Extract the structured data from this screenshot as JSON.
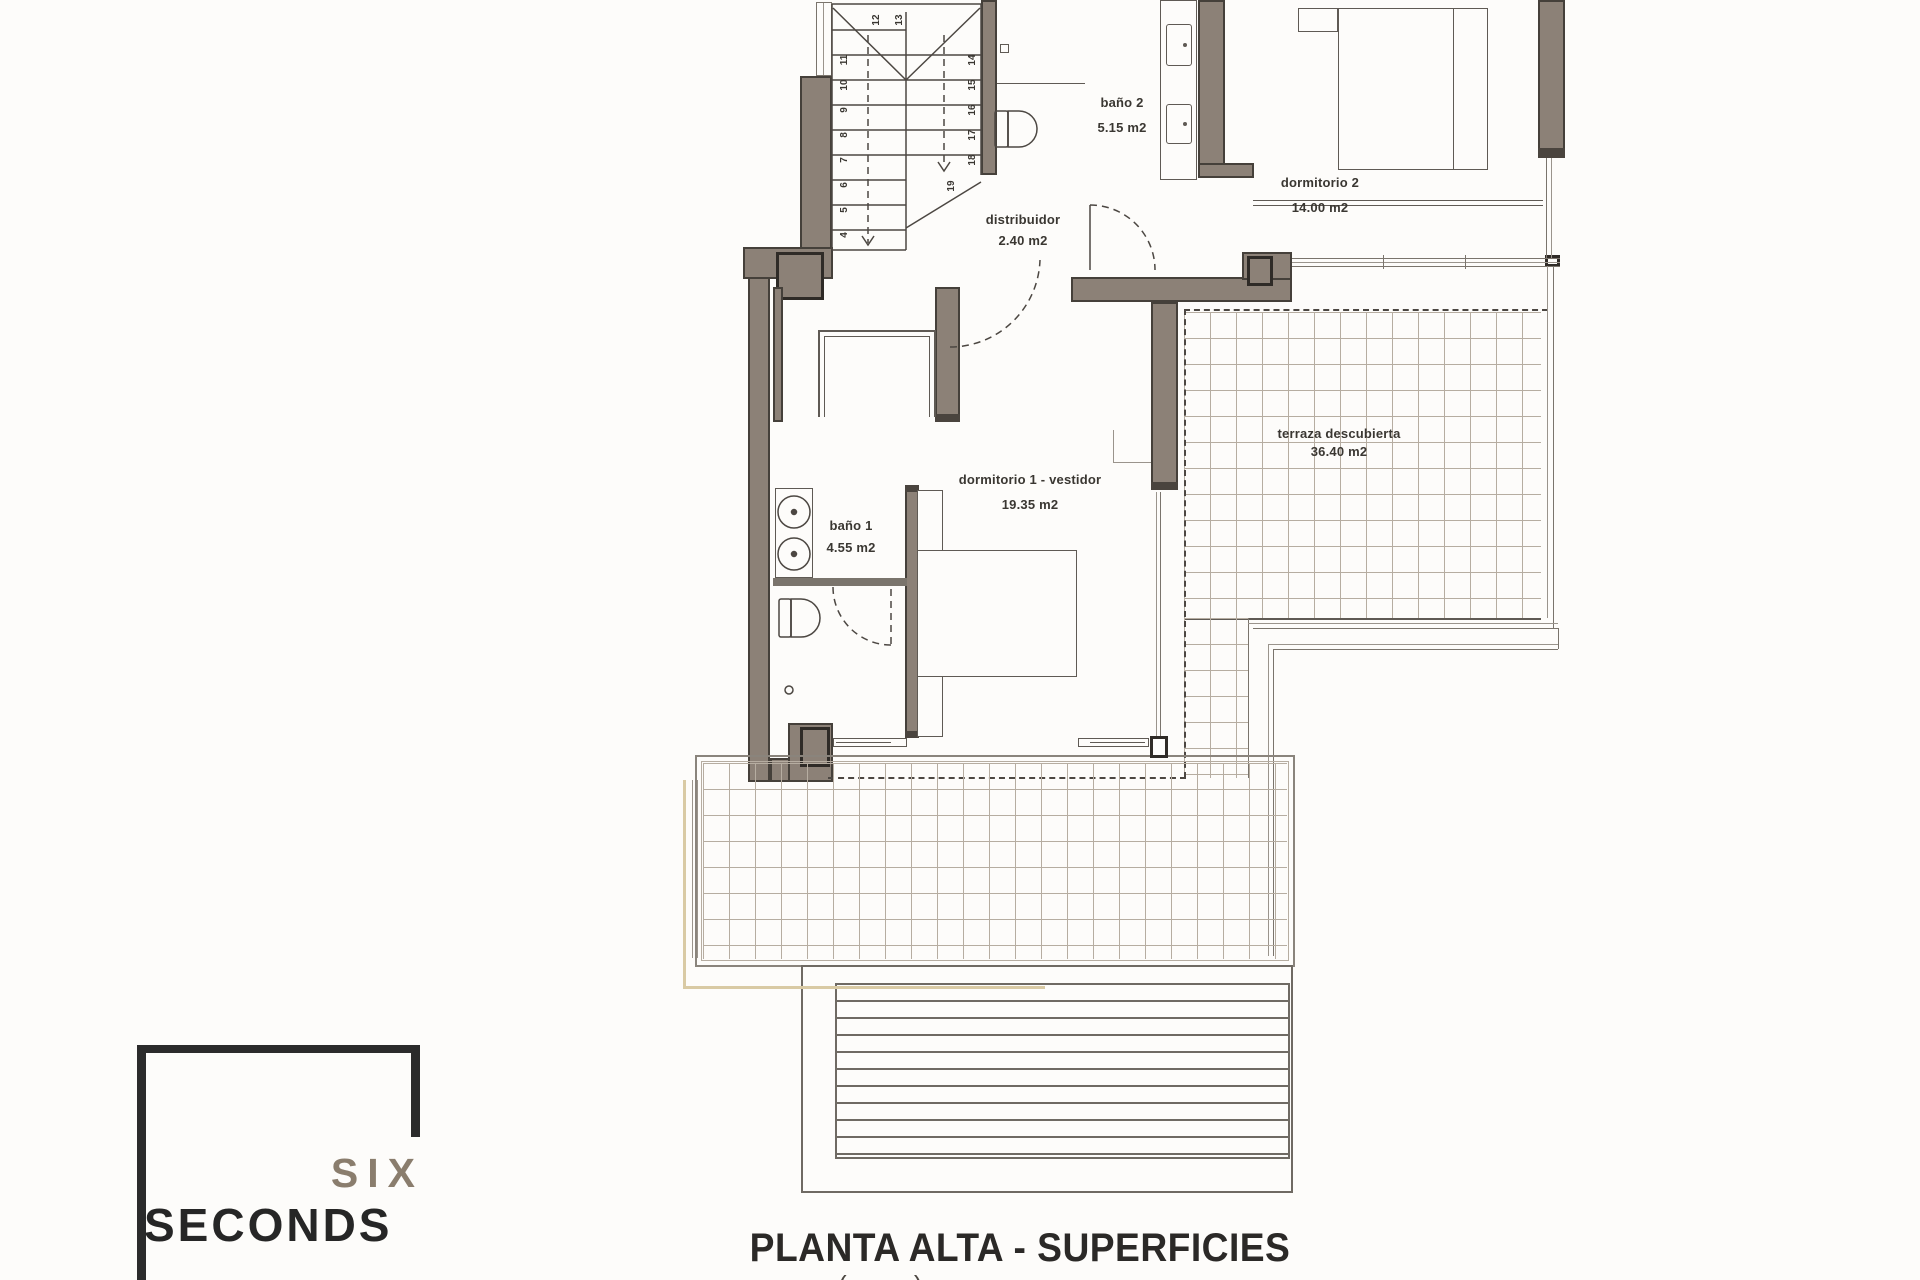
{
  "title": "PLANTA ALTA - SUPERFICIES",
  "footer_partial": "( )",
  "logo": {
    "line1": "SIX",
    "line2": "SECONDS"
  },
  "rooms": [
    {
      "id": "bano2",
      "name": "baño 2",
      "area": "5.15 m2"
    },
    {
      "id": "dormitorio2",
      "name": "dormitorio 2",
      "area": "14.00 m2"
    },
    {
      "id": "distribuidor",
      "name": "distribuidor",
      "area": "2.40 m2"
    },
    {
      "id": "dormitorio1",
      "name": "dormitorio 1 - vestidor",
      "area": "19.35 m2"
    },
    {
      "id": "bano1",
      "name": "baño 1",
      "area": "4.55 m2"
    },
    {
      "id": "terraza",
      "name": "terraza descubierta",
      "area": "36.40 m2"
    }
  ],
  "stair": {
    "steps": [
      "4",
      "5",
      "6",
      "7",
      "8",
      "9",
      "10",
      "11",
      "12",
      "13",
      "14",
      "15",
      "16",
      "17",
      "18",
      "19"
    ]
  },
  "colors": {
    "wall": "#8c8177",
    "wall_outline": "#45403a",
    "line": "#5f5a54",
    "accent_tan": "#d9caa4",
    "logo_six": "#8a7d6d",
    "logo_seconds": "#262626"
  }
}
